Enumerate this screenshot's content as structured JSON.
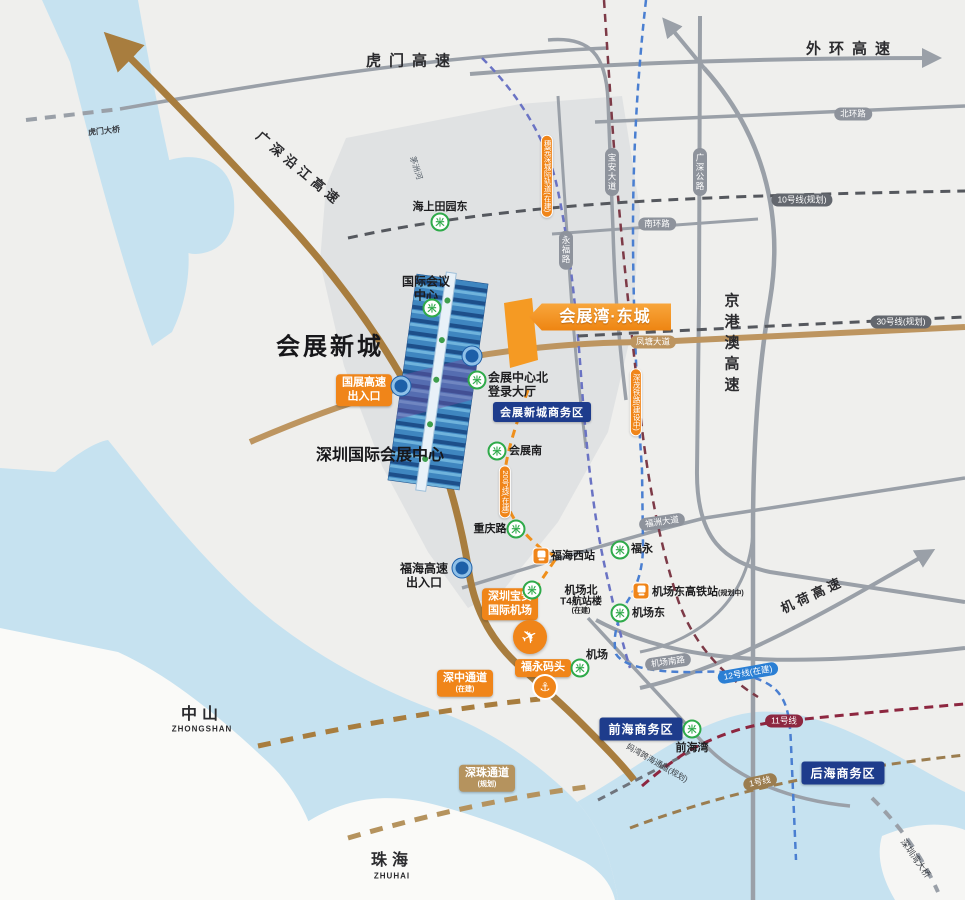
{
  "project_banner": {
    "label": "会展湾·东城",
    "color": "#f08519"
  },
  "areas": {
    "huizhan_xincheng": "会展新城",
    "szicec": "深圳国际会展中心",
    "intl_conference_line1": "国际会议",
    "intl_conference_line2": "中心",
    "cbd_badge": "会展新城商务区",
    "qianhai_badge": "前海商务区",
    "houhai_badge": "后海商务区",
    "zhongshan": "中山",
    "zhongshan_en": "ZHONGSHAN",
    "zhuhai": "珠海",
    "zhuhai_en": "ZHUHAI"
  },
  "airport": {
    "badge_line1": "深圳宝安",
    "badge_line2": "国际机场"
  },
  "ferry": {
    "badge": "福永码头"
  },
  "corridors": {
    "shenzhong_line1": "深中通道",
    "shenzhong_line2": "(在建)",
    "shenzhu_line1": "深珠通道",
    "shenzhu_line2": "(规划)",
    "mawan": "妈湾跨海通道(规划)",
    "szw_bridge": "深圳湾大桥",
    "humen_bridge": "虎门大桥"
  },
  "highways": {
    "humen": "虎门高速",
    "waihuan": "外环高速",
    "yanjiang": "广深沿江高速",
    "jinggangao": "京港澳高速",
    "jihe": "机荷高速",
    "guozhan_exit_line1": "国展高速",
    "guozhan_exit_line2": "出入口",
    "fuhai_exit_line1": "福海高速",
    "fuhai_exit_line2": "出入口"
  },
  "roads": {
    "beihuan": "北环路",
    "nanhuan": "南环路",
    "baoan": "宝安大道",
    "guangshen": "广深公路",
    "yongfu": "永福路",
    "fengtang": "凤塘大道",
    "fuzhou": "福洲大道",
    "jichangnan": "机场南路",
    "maozhou_river": "茅洲河"
  },
  "rails": {
    "suiwanshen": "穗莞深城际轨道(在建)",
    "shenmao": "深茂铁路(建设中)",
    "line10": "10号线(规划)",
    "line30": "30号线(规划)",
    "line20": "20号线(在建)",
    "line12": "12号线(在建)",
    "line11": "11号线",
    "line1": "1号线"
  },
  "stations": {
    "haishangtianyuandong": "海上田园东",
    "huizhan_bei_line1": "会展中心北",
    "huizhan_bei_line2": "登录大厅",
    "huizhan_nan": "会展南",
    "chongqinglu": "重庆路",
    "fuhaixi": "福海西站",
    "fuyong": "福永",
    "jichangbei_line1": "机场北",
    "jichangbei_line2": "T4航站楼",
    "jichangbei_line3": "(在建)",
    "jichang": "机场",
    "jichangdong": "机场东",
    "jichangdong_hsr": "机场东高铁站",
    "jichangdong_hsr_sub": "(规划中)",
    "qianhaiwan": "前海湾"
  },
  "icons": {
    "metro_glyph": "米",
    "anchor_glyph": "⚓",
    "plane_glyph": "✈"
  },
  "colors": {
    "accent_orange": "#f08519",
    "badge_navy": "#1e3c8c",
    "metro_green": "#2faa4a",
    "expressway_brown": "#a87d3e",
    "water": "#c6e2f0",
    "line12_blue": "#2b7fd4",
    "line11_maroon": "#8d2740",
    "line1_tan": "#9b7d4f",
    "line20_orange": "#ef8f1c"
  }
}
